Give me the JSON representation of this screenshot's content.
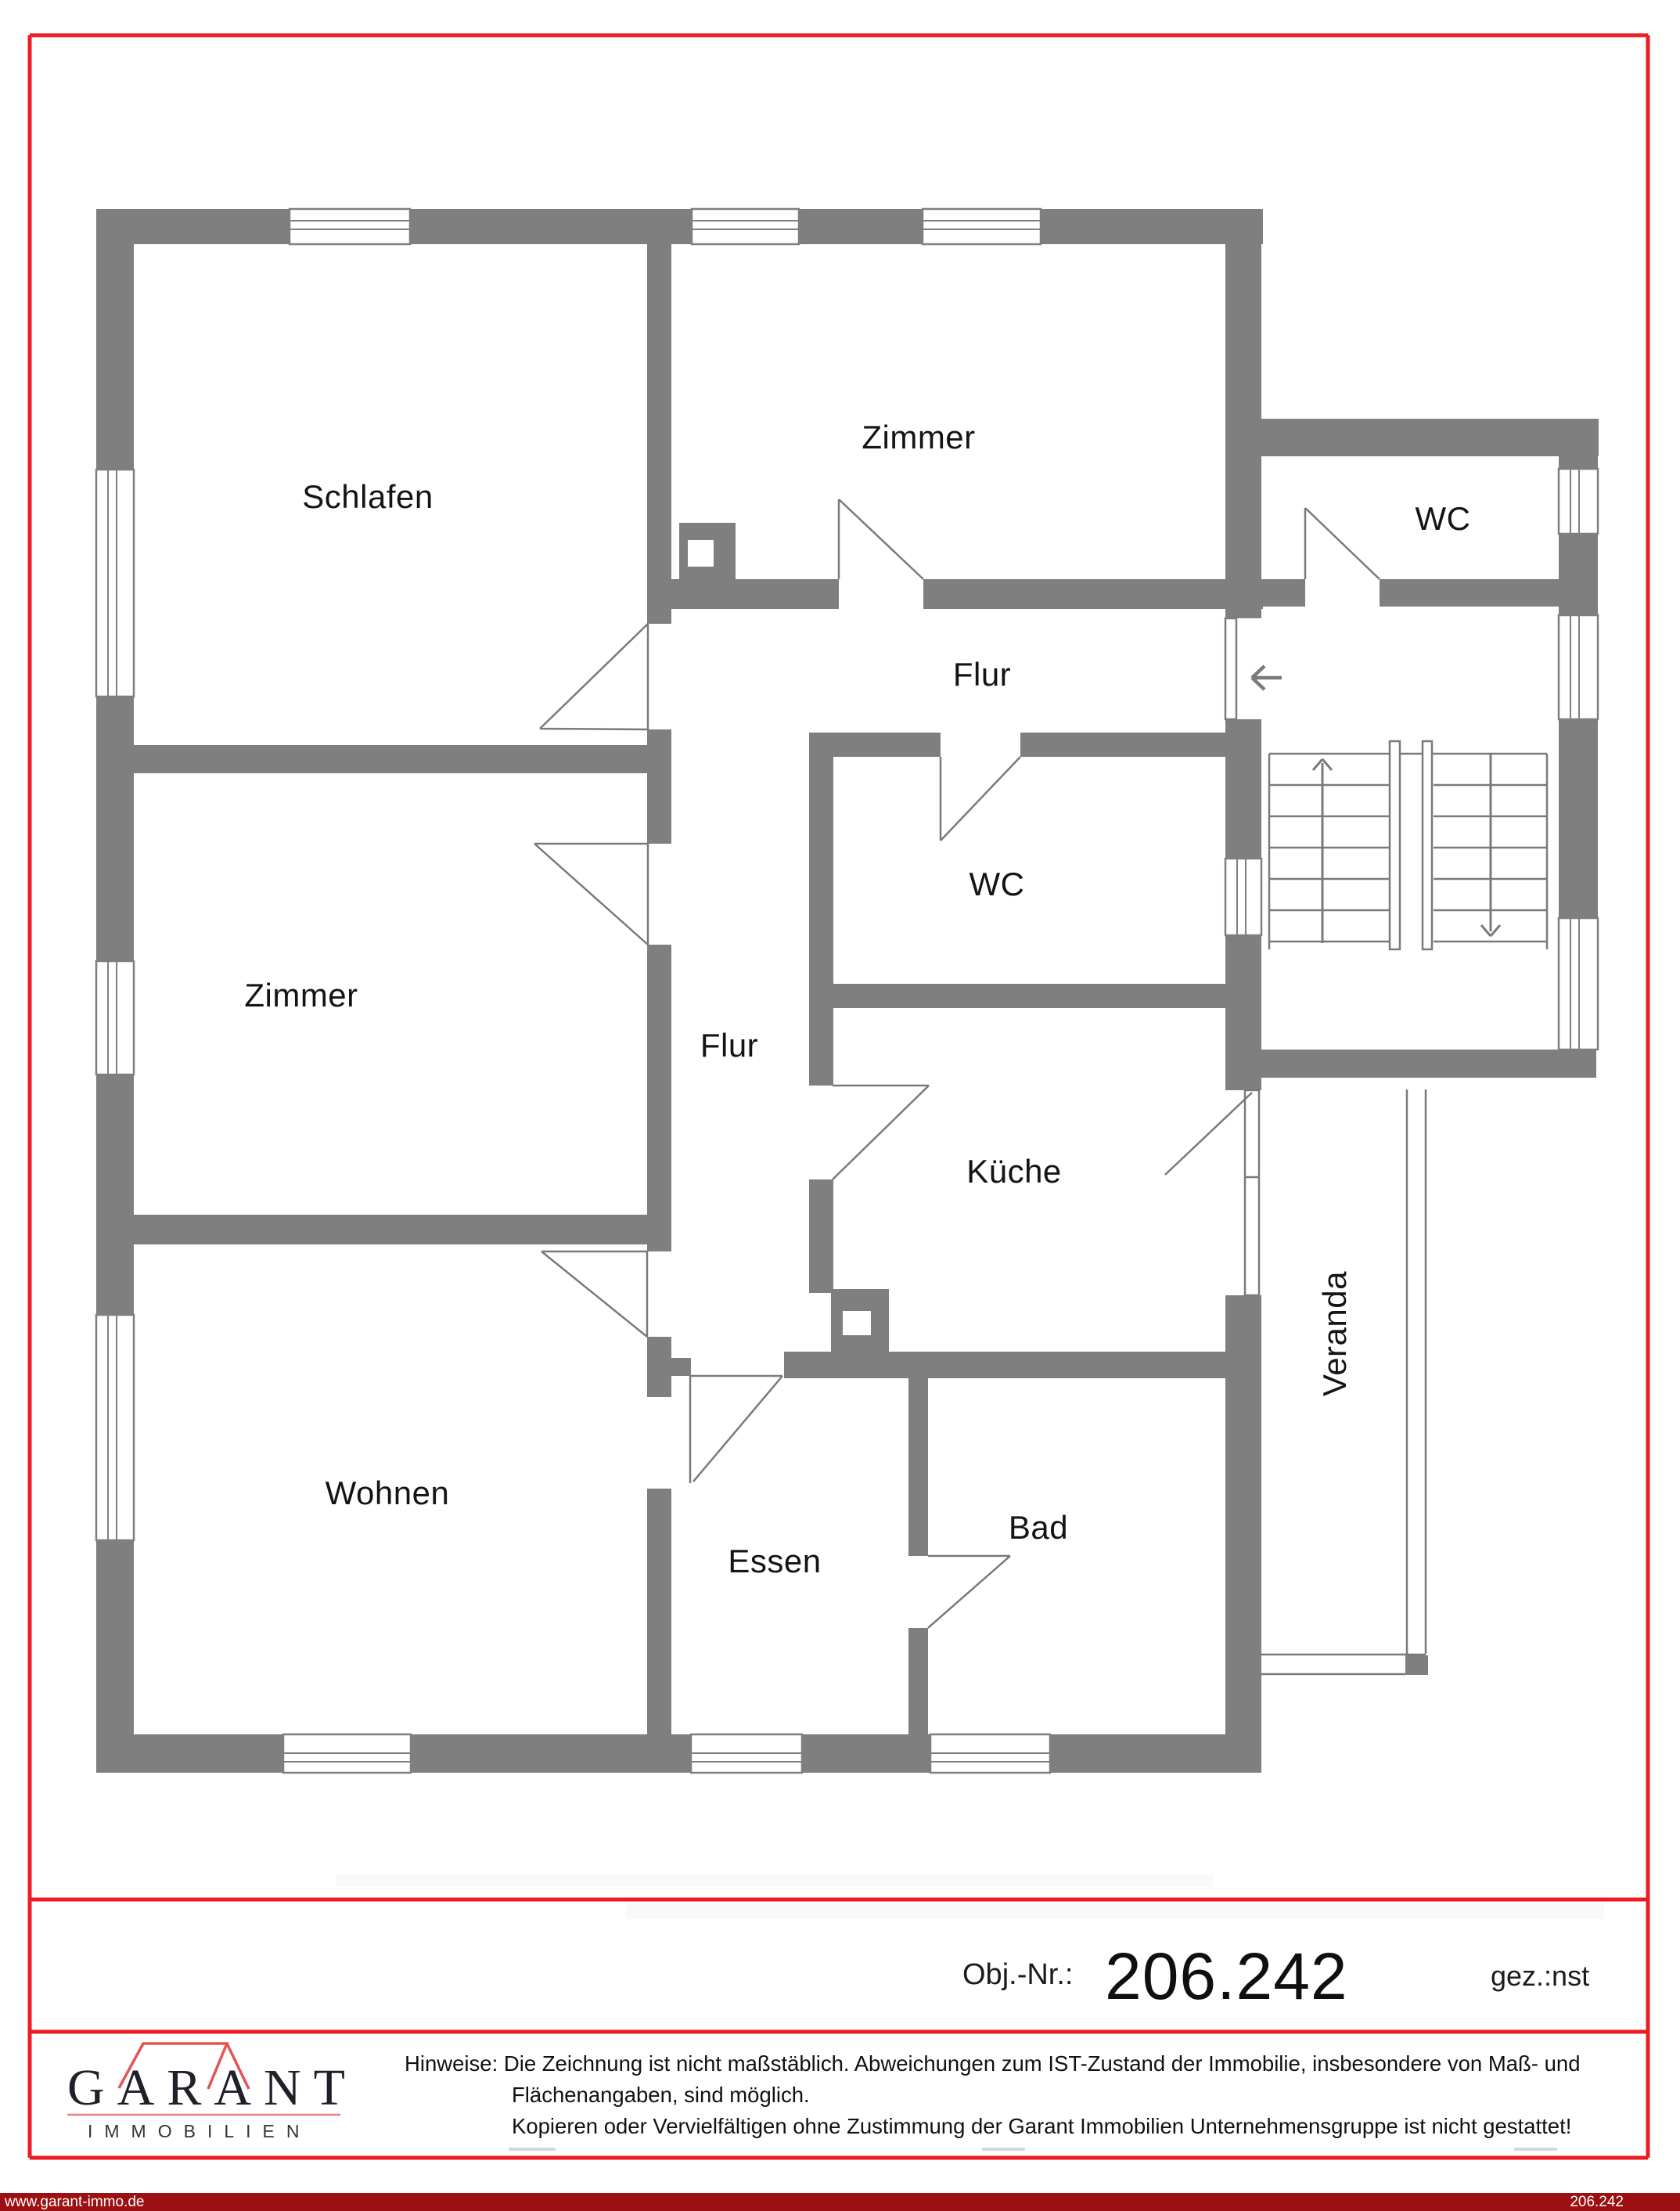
{
  "page": {
    "type": "real-estate floor plan sheet",
    "accent_red": "#ed1c24",
    "wall_gray": "#7f7f7f",
    "footer_bar_red": "#9c1013",
    "background": "#ffffff"
  },
  "plan": {
    "rooms": {
      "schlafen": "Schlafen",
      "zimmer_top": "Zimmer",
      "wc_top": "WC",
      "flur_top": "Flur",
      "wc_mid": "WC",
      "zimmer_left": "Zimmer",
      "flur_lower": "Flur",
      "kueche": "Küche",
      "wohnen": "Wohnen",
      "essen": "Essen",
      "bad": "Bad",
      "veranda": "Veranda"
    },
    "icons": {
      "entry_arrow": "arrow-left",
      "stairs_up_arrow": "arrow-up",
      "stairs_down_arrow": "arrow-down"
    }
  },
  "object_info": {
    "label": "Obj.-Nr.:",
    "number": "206.242",
    "drawn_by": "gez.:nst"
  },
  "brand": {
    "name": "GARANT",
    "subtitle": "IMMOBILIEN"
  },
  "notes": {
    "line1": "Hinweise: Die Zeichnung ist nicht maßstäblich. Abweichungen zum IST-Zustand der Immobilie, insbesondere von Maß- und",
    "line2": "Flächenangaben, sind möglich.",
    "line3": "Kopieren oder Vervielfältigen ohne Zustimmung der Garant Immobilien Unternehmensgruppe ist nicht gestattet!"
  },
  "footer": {
    "website": "www.garant-immo.de",
    "object_number": "206.242"
  }
}
